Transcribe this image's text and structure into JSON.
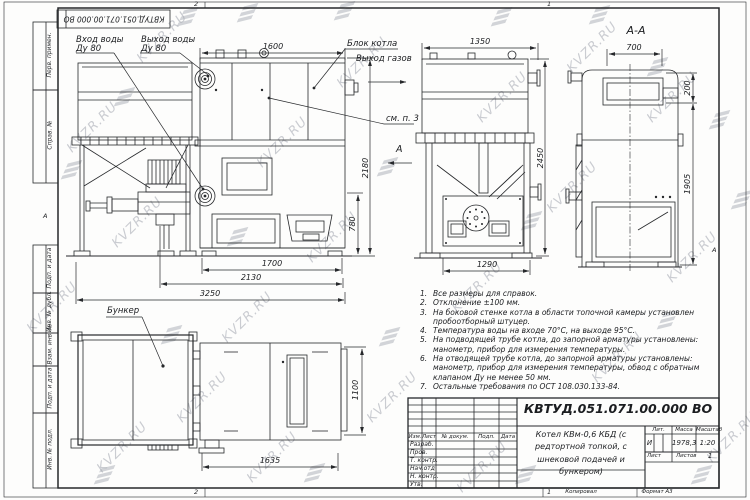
{
  "watermark": {
    "text": "KVZR.RU"
  },
  "stamp": {
    "doc_number": "КВТУД.051.071.00.000 ВО"
  },
  "zones": {
    "top_2": "2",
    "top_1": "1",
    "bottom_2": "2",
    "bottom_1": "1",
    "left_a": "А",
    "right_a": "А"
  },
  "margin": {
    "perv_primen": "Перв. примен.",
    "sprav_no": "Справ. №",
    "podp_data_1": "Подп. и дата",
    "inv_dubl": "Инв. № дубл.",
    "vzam_inv": "Взам. инв. №",
    "podp_data_2": "Подп. и дата",
    "inv_podl": "Инв. № подл."
  },
  "labels": {
    "inlet_line1": "Вход воды",
    "inlet_line2": "Ду 80",
    "outlet_line1": "Выход воды",
    "outlet_line2": "Ду 80",
    "boiler_block": "Блок котла",
    "gas_outlet": "Выход газов",
    "see_note_3": "см. п. 3",
    "hopper": "Бункер",
    "section_title": "А-А",
    "section_arrow": "А"
  },
  "dims": {
    "d1600": "1600",
    "d1350": "1350",
    "d700": "700",
    "d200": "200",
    "d2450": "2450",
    "d2180": "2180",
    "d780": "780",
    "d1700": "1700",
    "d2130": "2130",
    "d3250": "3250",
    "d1290": "1290",
    "d1905": "1905",
    "d1100": "1100",
    "d1635": "1635"
  },
  "notes": {
    "items": [
      {
        "num": "1.",
        "text": "Все размеры для справок."
      },
      {
        "num": "2.",
        "text": "Отклонение ±100 мм."
      },
      {
        "num": "3.",
        "text": "На боковой стенке котла в области топочной камеры установлен пробоотборный штуцер."
      },
      {
        "num": "4.",
        "text": "Температура воды на входе 70°С, на выходе 95°С."
      },
      {
        "num": "5.",
        "text": "На подводящей трубе котла, до запорной арматуры установлены: манометр, прибор для измерения температуры."
      },
      {
        "num": "6.",
        "text": "На отводящей трубе котла, до запорной арматуры установлены: манометр, прибор для измерения температуры, обвод с обратным клапаном Ду не менее 50 мм."
      },
      {
        "num": "7.",
        "text": "Остальные требования по ОСТ 108.030.133-84."
      }
    ]
  },
  "title_block": {
    "doc_number": "КВТУД.051.071.00.000 ВО",
    "product": "Котел КВм-0,6 КБД (с редтортной топкой, с шнековой подачей и бункером)",
    "col_izm": "Изм.",
    "col_list": "Лист",
    "col_docum": "№ докум.",
    "col_podp": "Подп.",
    "col_data": "Дата",
    "row_razrab": "Разраб.",
    "row_prov": "Пров.",
    "row_tkontr": "Т. контр.",
    "row_nachotd": "Нач.отд",
    "row_nkontr": "Н. контр.",
    "row_utv": "Утв.",
    "lit_label": "Лит.",
    "lit_value": "И",
    "massa_label": "Масса",
    "massa_value": "1978,3",
    "masshtab_label": "Масштаб",
    "masshtab_value": "1:20",
    "list_label": "Лист",
    "listov_label": "Листов",
    "listov_value": "1",
    "kopiroval": "Копировал",
    "format": "Формат А3"
  }
}
